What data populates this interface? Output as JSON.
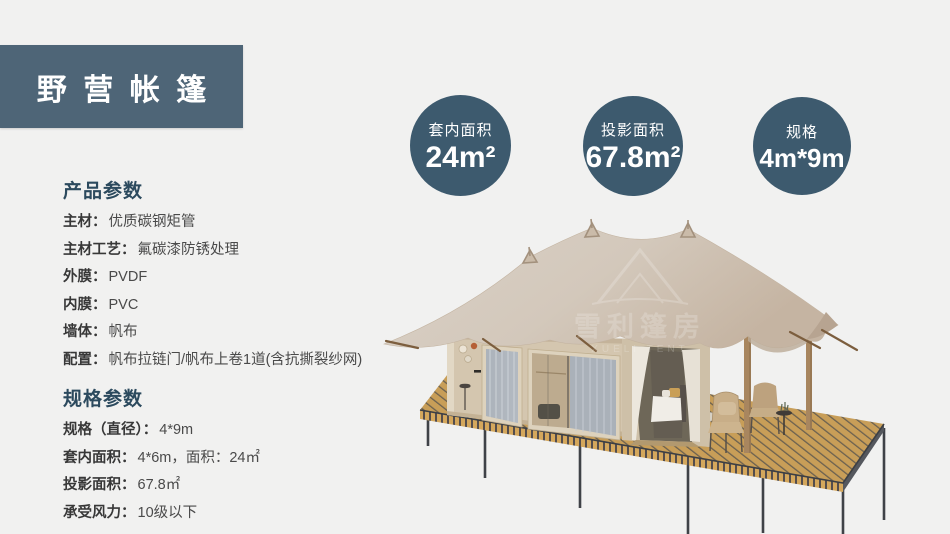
{
  "header": {
    "title": "野营帐篷"
  },
  "stat_circles": [
    {
      "label": "套内面积",
      "value": "24m²"
    },
    {
      "label": "投影面积",
      "value": "67.8m²"
    },
    {
      "label": "规格",
      "value": "4m*9m"
    }
  ],
  "product_params": {
    "heading": "产品参数",
    "rows": [
      {
        "label": "主材：",
        "value": "优质碳钢矩管"
      },
      {
        "label": "主材工艺：",
        "value": "氟碳漆防锈处理"
      },
      {
        "label": "外膜：",
        "value": "PVDF"
      },
      {
        "label": "内膜：",
        "value": "PVC"
      },
      {
        "label": "墙体：",
        "value": "帆布"
      },
      {
        "label": "配置：",
        "value": "帆布拉链门/帆布上卷1道(含抗撕裂纱网)"
      }
    ]
  },
  "spec_params": {
    "heading": "规格参数",
    "rows": [
      {
        "label": "规格（直径）：",
        "value": "4*9m"
      },
      {
        "label": "套内面积：",
        "value": "4*6m，面积：24㎡"
      },
      {
        "label": "投影面积：",
        "value": "67.8㎡"
      },
      {
        "label": "承受风力：",
        "value": "10级以下"
      }
    ]
  },
  "tent_image": {
    "watermark_line1": "雪利篷房",
    "watermark_line2": "XUELI TENT"
  },
  "colors": {
    "background": "#f1f1f0",
    "banner": "#4e6577",
    "circle": "#3d5a6e",
    "heading_text": "#2c4a5e",
    "roof_beige": "#d3c8bb",
    "deck_wood": "#c89e58"
  }
}
